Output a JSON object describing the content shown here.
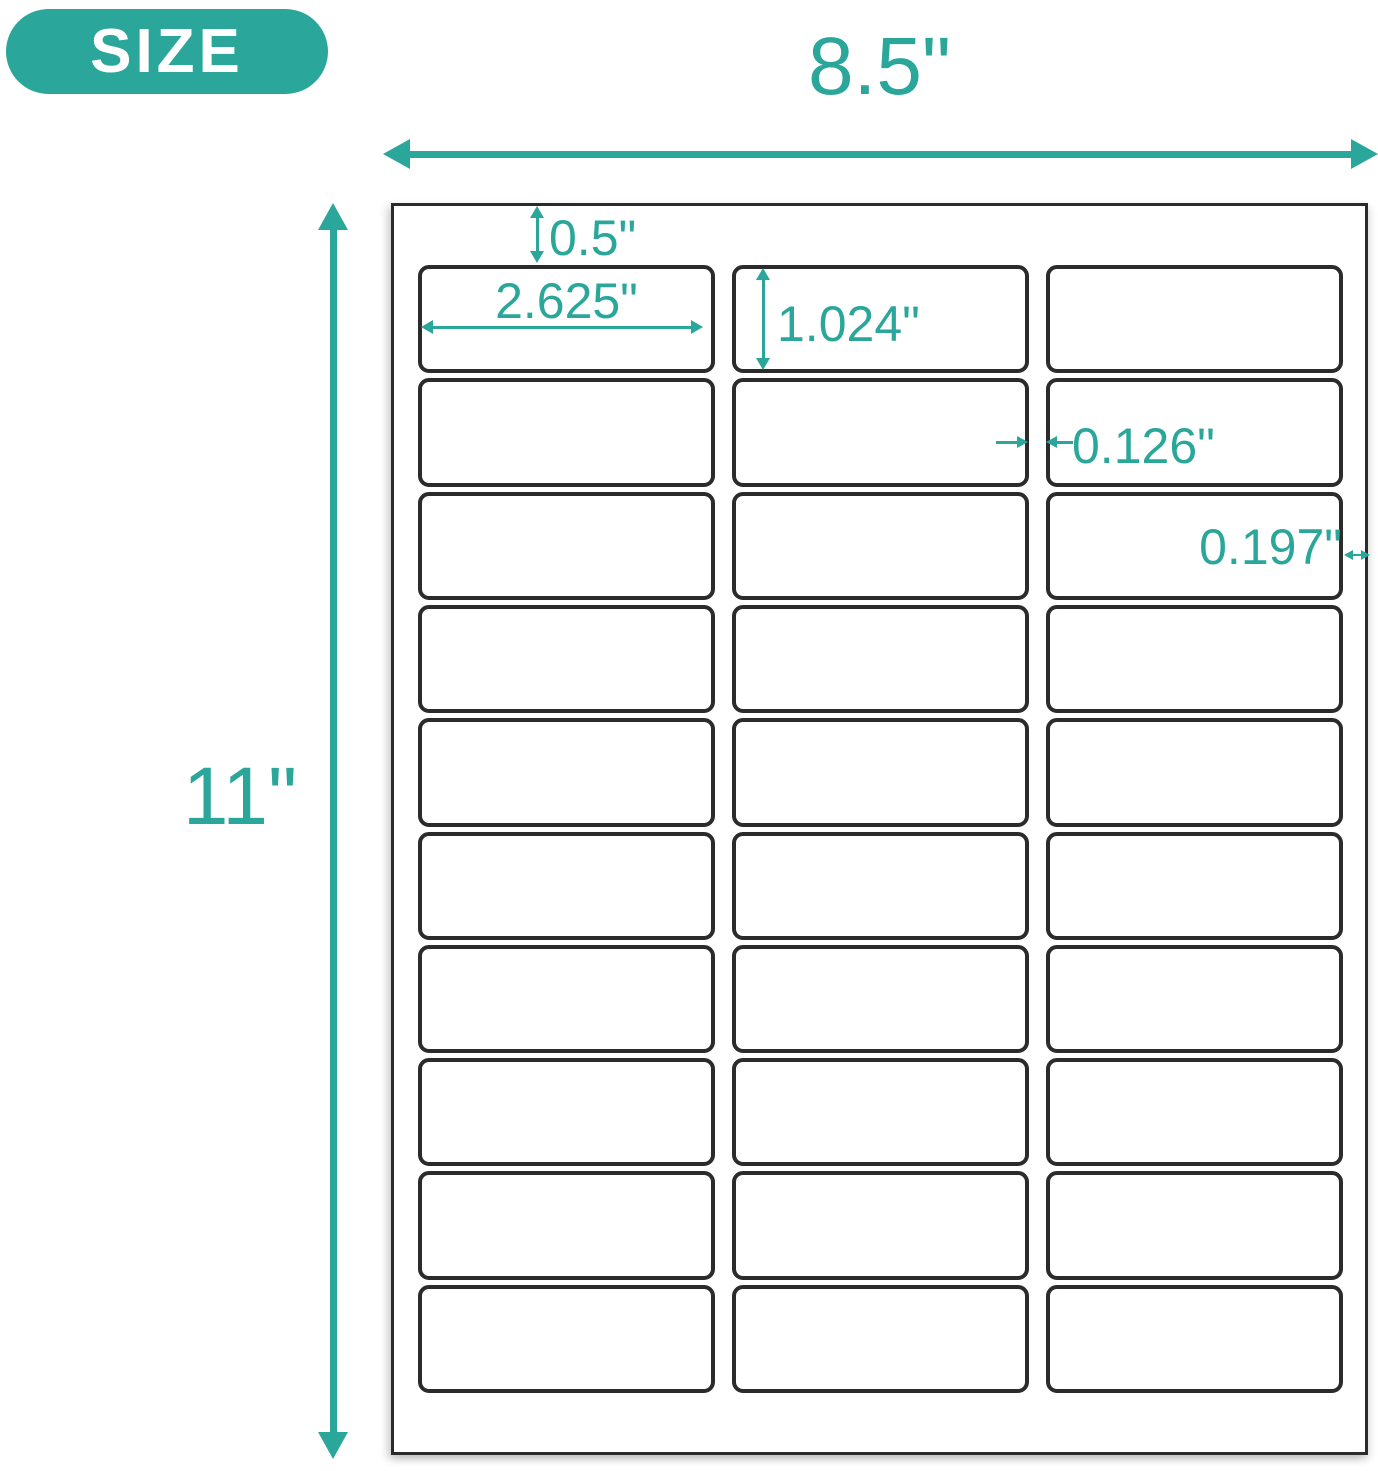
{
  "badge": {
    "label": "SIZE"
  },
  "colors": {
    "accent": "#2aa79a",
    "outline": "#2b2b2b",
    "paper": "#ffffff",
    "badge_text": "#ffffff"
  },
  "dimensions": {
    "sheet_width": "8.5\"",
    "sheet_height": "11\"",
    "top_margin": "0.5\"",
    "label_width": "2.625\"",
    "label_height": "1.024\"",
    "column_gap": "0.126\"",
    "side_margin": "0.197\""
  },
  "sheet": {
    "columns": 3,
    "rows": 10,
    "label_count": 30
  }
}
